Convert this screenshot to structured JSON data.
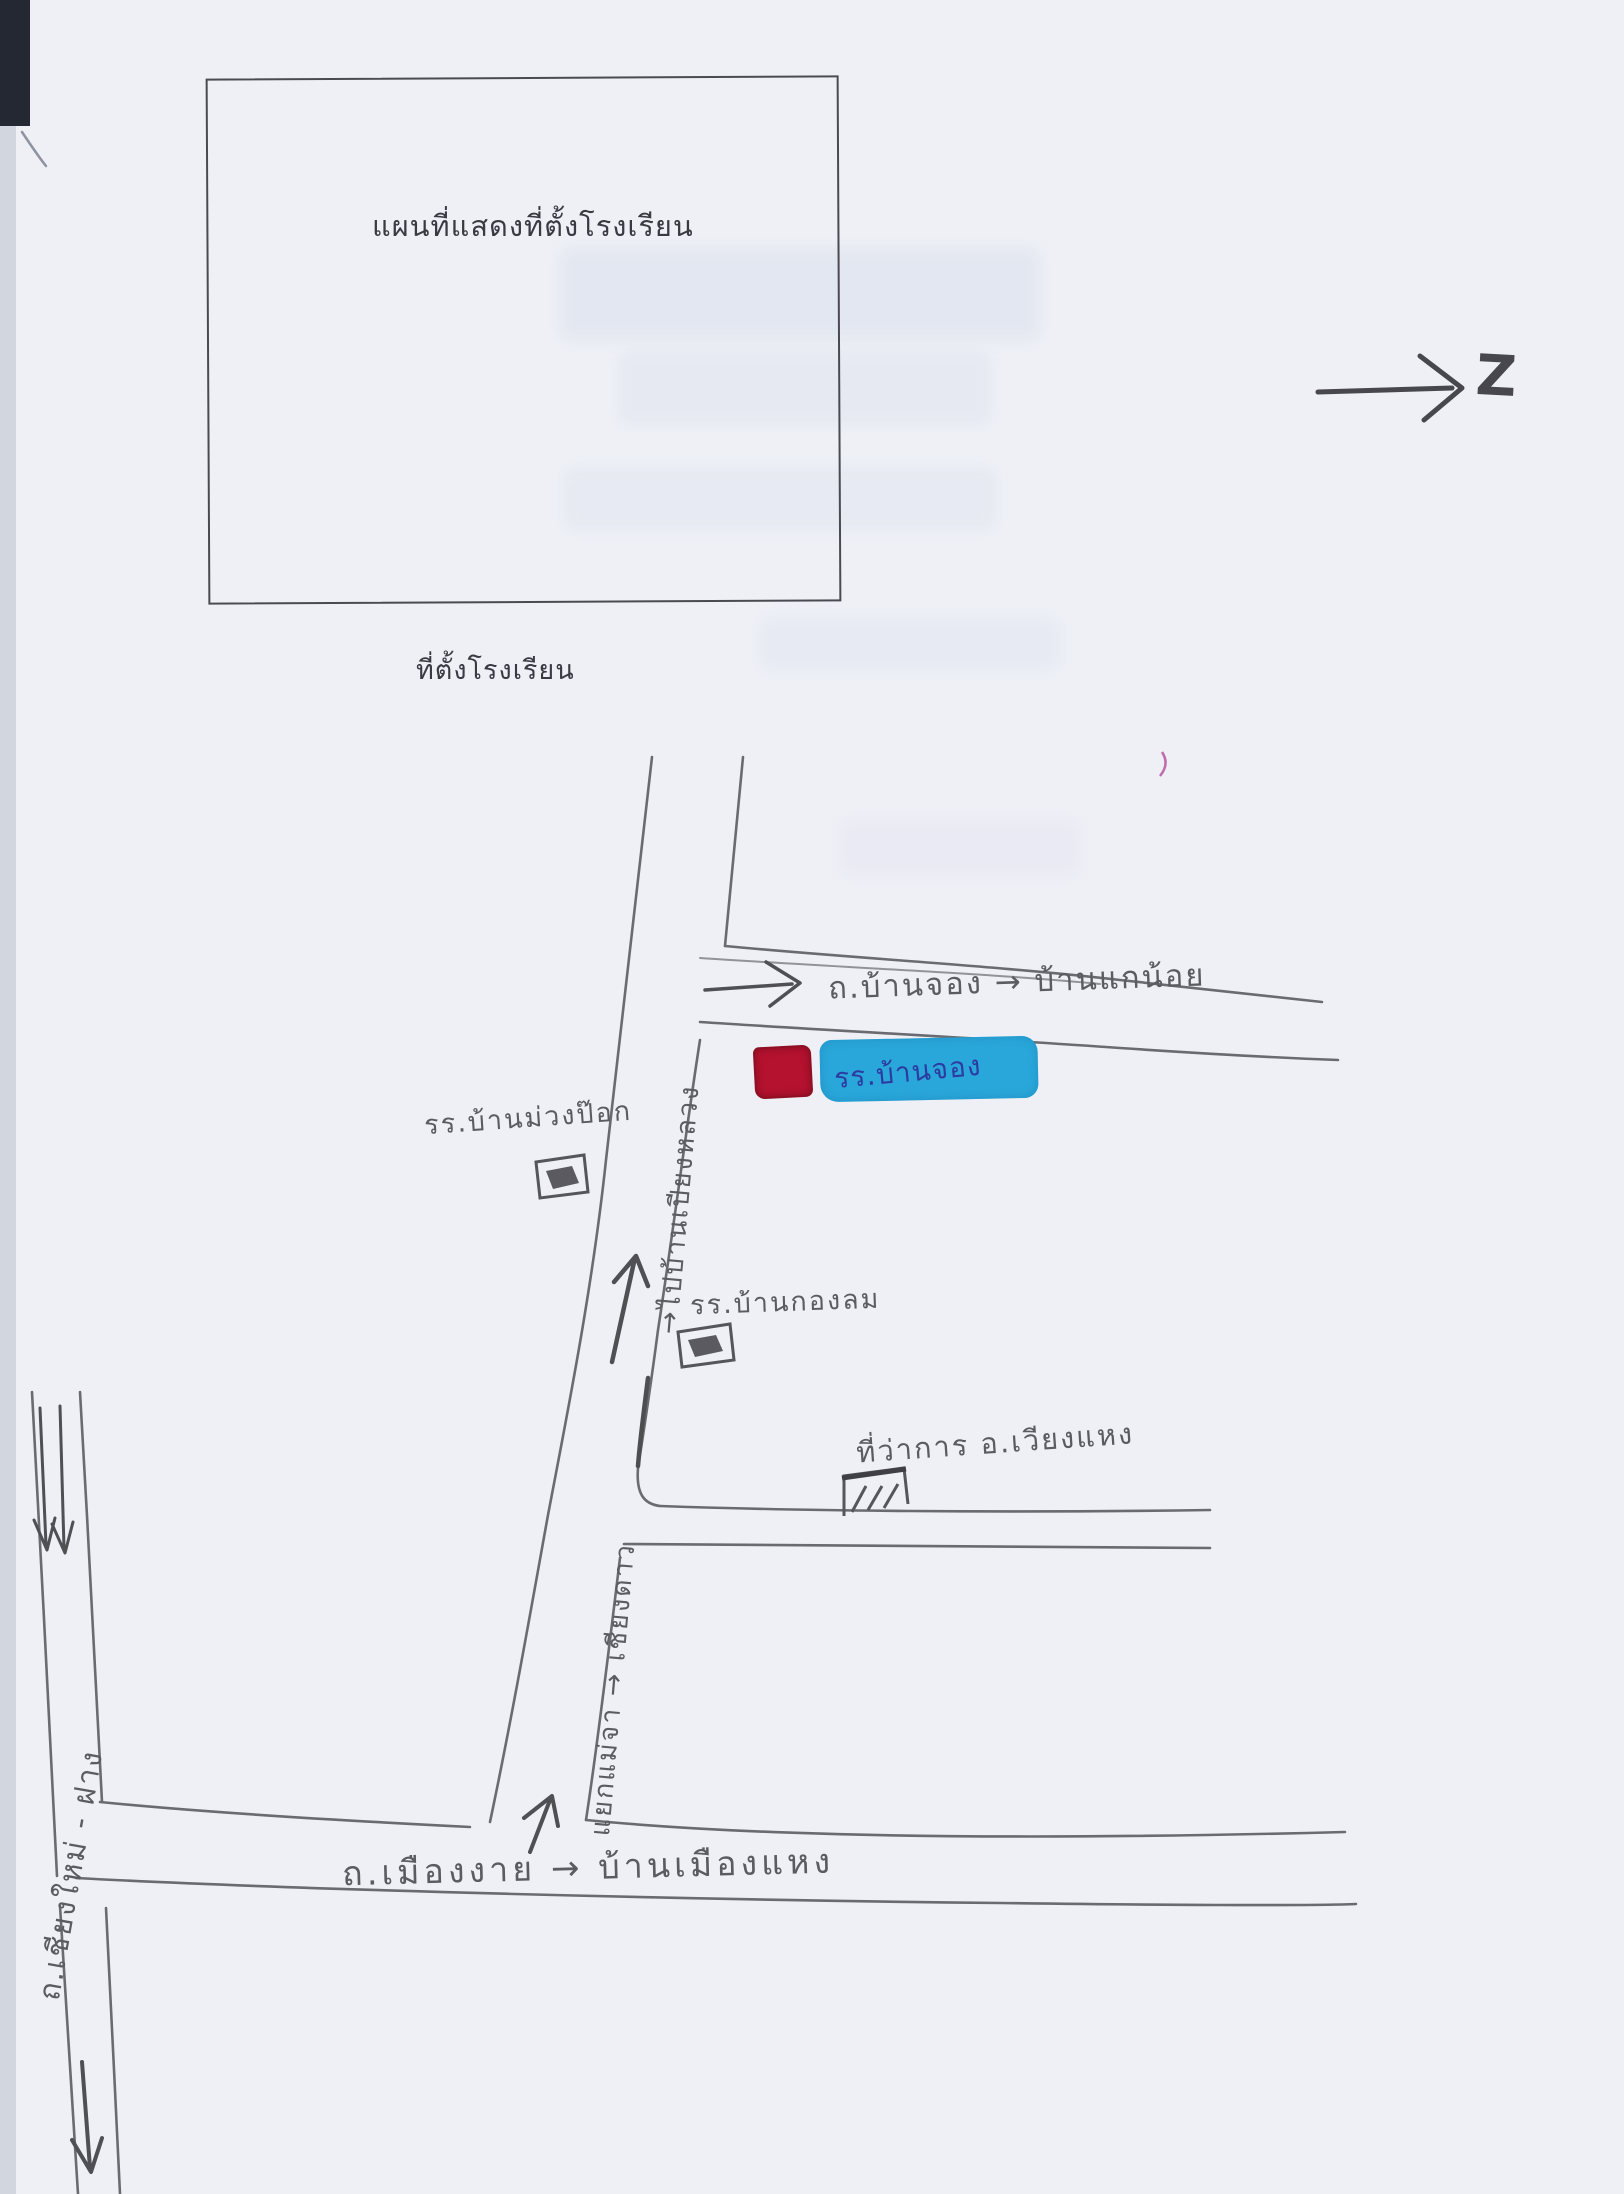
{
  "page": {
    "title_box_title": "แผนที่แสดงที่ตั้งโรงเรียน",
    "subtitle": "ที่ตั้งโรงเรียน"
  },
  "north": {
    "glyph": "Z"
  },
  "map": {
    "roads": {
      "top_road": {
        "label": "ถ.บ้านจอง → บ้านแกน้อย"
      },
      "vertical_road": {
        "label": "→ไปบ้านเปียงหลวง"
      },
      "lower_vertical_road": {
        "label": "แยกแม่จา → เชียงดาว"
      },
      "bottom_road": {
        "label": "ถ.เมืองงาย → บ้านเมืองแหง"
      },
      "left_road": {
        "label": "ถ.เชียงใหม่ - ฝาง"
      }
    },
    "places": {
      "school_highlighted": {
        "label": "รร.บ้านจอง"
      },
      "school_muang_pok": {
        "label": "รร.บ้านม่วงป๊อก"
      },
      "school_kong_lom": {
        "label": "รร.บ้านกองลม"
      },
      "district_office": {
        "label": "ที่ว่าการ อ.เวียงแหง"
      }
    }
  },
  "colors": {
    "marker_red": "#b5122f",
    "highlight_blue": "#2aa7da",
    "ink_blue": "#2c3ba0",
    "pencil_gray": "#6a6b70",
    "paper": "#eef0f6"
  }
}
